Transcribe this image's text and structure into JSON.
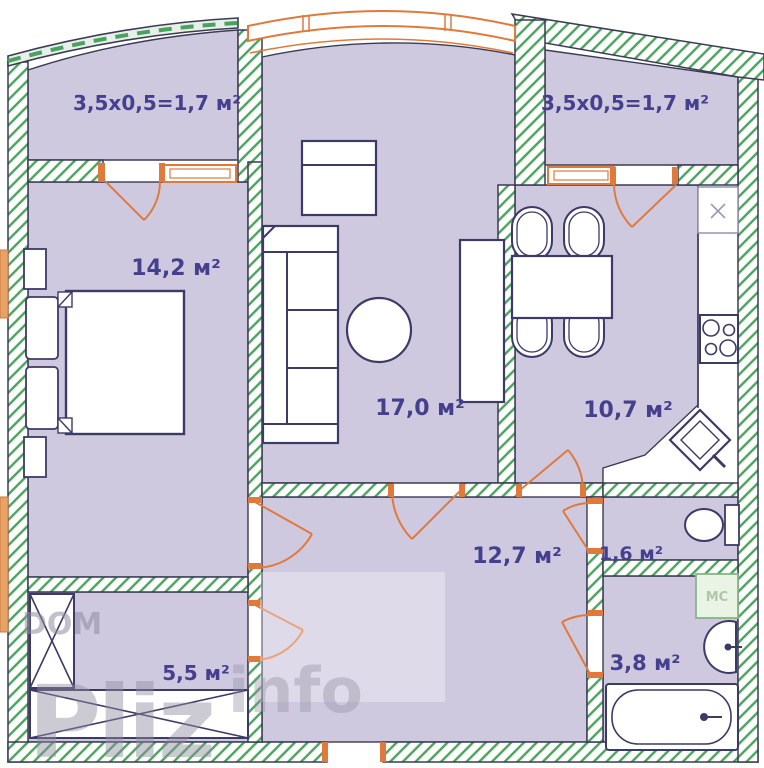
{
  "plan": {
    "type": "apartment-floor-plan",
    "rooms": {
      "balcony_left": "3,5x0,5=1,7 м²",
      "balcony_right": "3,5x0,5=1,7 м²",
      "bedroom": "14,2 м²",
      "living_room": "17,0 м²",
      "kitchen": "10,7 м²",
      "hallway": "12,7 м²",
      "wc": "1,6 м²",
      "bathroom": "3,8 м²",
      "storage": "5,5 м²"
    },
    "labels": {
      "washing_machine": "МС"
    },
    "watermark": {
      "word1": "DOM",
      "word2": "Pliz",
      "word3": "info"
    },
    "colors": {
      "floor": "#cfc9df",
      "wall_hatch_green": "#49a35c",
      "wall_outline": "#3b3b55",
      "furniture_outline": "#3c3a66",
      "door_window_orange": "#e07a3c",
      "room_label": "#45408e",
      "washing_machine_green": "#8fbc8f"
    }
  }
}
